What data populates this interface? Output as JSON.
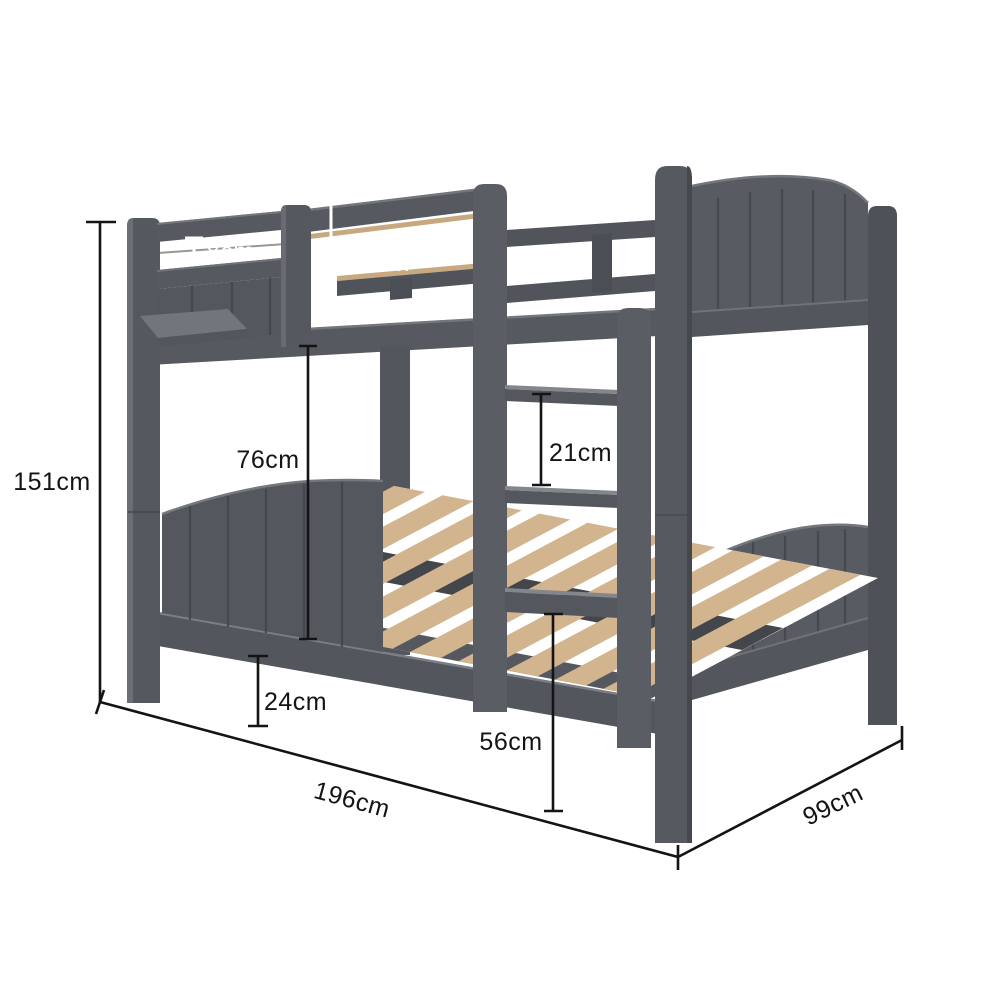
{
  "diagram": {
    "product": "grey-bunk-bed-dimension-diagram",
    "unit": "cm",
    "colors": {
      "background": "#ffffff",
      "frame": "#55585e",
      "frame_dark": "#474a50",
      "frame_light": "#75787e",
      "slats": "#d2b48e",
      "dimension_black": "#141414",
      "dimension_white": "#ffffff"
    },
    "measurements": {
      "overall_height": {
        "label": "151cm",
        "value": 151
      },
      "rail_gap": {
        "label": "8cm",
        "value": 8
      },
      "guardrail_height": {
        "label": "37cm",
        "value": 37
      },
      "under_bunk_clearance": {
        "label": "76cm",
        "value": 76
      },
      "ladder_rung_spacing": {
        "label": "21cm",
        "value": 21
      },
      "under_bed_clearance": {
        "label": "24cm",
        "value": 24
      },
      "lower_bunk_height": {
        "label": "56cm",
        "value": 56
      },
      "bed_length": {
        "label": "196cm",
        "value": 196
      },
      "bed_width": {
        "label": "99cm",
        "value": 99
      }
    }
  }
}
